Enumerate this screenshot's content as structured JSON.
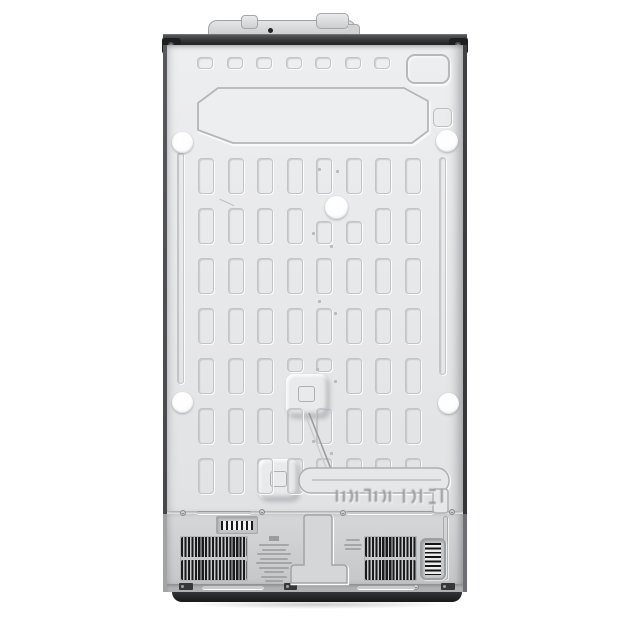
{
  "subject": "refrigerator-back-panel-photo",
  "background": "#ffffff",
  "palette": {
    "panel": "#e9eaec",
    "panel_hi": "#edeef0",
    "emboss_line": "#c2c4c7",
    "emboss_dark": "#aaacaf",
    "top_trim": "#2b2c2e",
    "bracket": "#1e1f21",
    "hinge_cover": "#d8d9db",
    "lower_panel": "#cfd0d2",
    "band": "#b0b1b3",
    "kick_plate": "#222325",
    "vent_slat": "#191a1b",
    "plug": "#ffffff",
    "label_ink": "#97989b",
    "barcode_ink": "#1b1b1d"
  },
  "embossed_grid": {
    "cols": 8,
    "rows": 7,
    "x0": 198,
    "y0": 158,
    "pitch_x": 29.5,
    "pitch_y": 50,
    "cell_w": 16,
    "cell_h": 36,
    "variants": [
      {
        "row": 1,
        "col": 4,
        "dy": 13,
        "dh": -13
      },
      {
        "row": 1,
        "col": 5,
        "dy": 13,
        "dh": -13
      },
      {
        "row": 4,
        "col": 3,
        "dh": -22
      },
      {
        "row": 4,
        "col": 4,
        "dh": -22
      },
      {
        "row": 6,
        "col": 5,
        "dh": -10
      },
      {
        "row": 6,
        "col": 6,
        "dh": -10
      },
      {
        "row": 6,
        "col": 7,
        "dh": -10
      }
    ]
  },
  "top_squares": {
    "count": 7,
    "x0": 197,
    "y": 57,
    "pitch": 29.5,
    "w": 16,
    "h": 12
  },
  "plug_holes": [
    {
      "x": 182,
      "y": 142,
      "d": 21
    },
    {
      "x": 447,
      "y": 141,
      "d": 22
    },
    {
      "x": 336,
      "y": 207,
      "d": 23
    },
    {
      "x": 182,
      "y": 402,
      "d": 21
    },
    {
      "x": 448,
      "y": 403,
      "d": 21
    }
  ],
  "rivet_dots": [
    [
      318,
      168
    ],
    [
      336,
      170
    ],
    [
      312,
      232
    ],
    [
      330,
      245
    ],
    [
      318,
      300
    ],
    [
      334,
      312
    ],
    [
      316,
      368
    ],
    [
      334,
      380
    ],
    [
      312,
      440
    ],
    [
      330,
      452
    ],
    [
      318,
      490
    ],
    [
      303,
      112
    ],
    [
      331,
      120
    ]
  ],
  "screws": [
    [
      183,
      513
    ],
    [
      262,
      512
    ],
    [
      343,
      513
    ],
    [
      452,
      512
    ],
    [
      416,
      587
    ]
  ],
  "vent_grilles": {
    "rows_per_grille": 2,
    "slat_pitch_px": 3.45,
    "left": {
      "x": 180,
      "y": 536,
      "w": 68,
      "h": 45
    },
    "right": {
      "x": 364,
      "y": 536,
      "w": 53,
      "h": 45
    }
  },
  "rating_label_lines": [
    30,
    24,
    34,
    28,
    36,
    30,
    20,
    26,
    18
  ],
  "cert_mark_lines": [
    14,
    18,
    16
  ],
  "embossed_stamp": {
    "present": true,
    "legible": false,
    "x": 334,
    "y": 486,
    "w": 114,
    "h": 20
  }
}
